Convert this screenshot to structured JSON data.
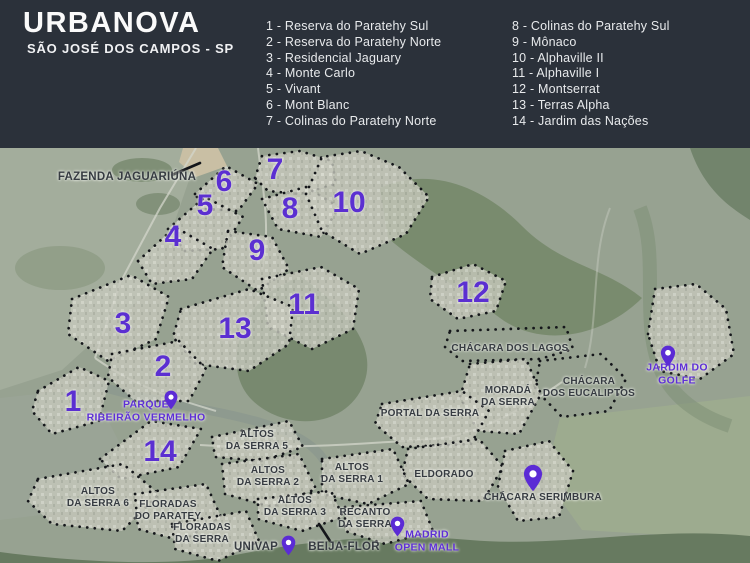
{
  "header": {
    "title": "URBANOVA",
    "subtitle": "SÃO JOSÉ DOS CAMPOS - SP",
    "legend_col1": [
      "1 - Reserva do Paratehy Sul",
      "2 - Reserva do Paratehy Norte",
      "3 - Residencial Jaguary",
      "4 - Monte Carlo",
      "5 - Vivant",
      "6 - Mont Blanc",
      "7 - Colinas do Paratehy Norte"
    ],
    "legend_col2": [
      "8 - Colinas do Paratehy Sul",
      "9 - Mônaco",
      "10 - Alphaville II",
      "11 - Alphaville I",
      "12 - Montserrat",
      "13 - Terras Alpha",
      "14 - Jardim das Nações"
    ]
  },
  "map": {
    "numbers": [
      "1",
      "2",
      "3",
      "4",
      "5",
      "6",
      "7",
      "8",
      "9",
      "10",
      "11",
      "12",
      "13",
      "14"
    ],
    "labels": {
      "fazenda_jaguariuna": "FAZENDA JAGUARIÚNA",
      "chacara_dos_lagos": "CHÁCARA DOS LAGOS",
      "morada_da_serra": "MORADÁ\nDA SERRA",
      "chacara_dos_eucaliptos": "CHÁCARA\nDOS EUCALIPTOS",
      "portal_da_serra": "PORTAL DA SERRA",
      "eldorado": "ELDORADO",
      "altos_da_serra_5": "ALTOS\nDA SERRA 5",
      "altos_da_serra_2": "ALTOS\nDA SERRA 2",
      "altos_da_serra_1": "ALTOS\nDA SERRA 1",
      "altos_da_serra_3": "ALTOS\nDA SERRA 3",
      "recanto_da_serra": "RECANTO\nDA SERRA",
      "altos_da_serra_6": "ALTOS\nDA SERRA 6",
      "floradas_do_paratey": "FLORADAS\nDO PARATEY",
      "floradas_da_serra": "FLORADAS\nDA SERRA",
      "univap": "UNIVAP",
      "beija_flor": "BEIJA-FLOR",
      "chacara_serimbura": "CHÁCARA SERIMBURA"
    },
    "poi": {
      "parque_ribeirao_vermelho": "PARQUE\nRIBEIRÃO VERMELHO",
      "jardim_do_golfe": "JARDIM DO GOLFE",
      "madrid_open_mall": "MADRID\nOPEN MALL"
    },
    "icons": {
      "pin": "map-pin-icon"
    },
    "colors": {
      "header_bg": "#2b313a",
      "accent_purple": "#5b2fd1",
      "label_dark": "#363b41",
      "map_base": "#97a291"
    }
  }
}
